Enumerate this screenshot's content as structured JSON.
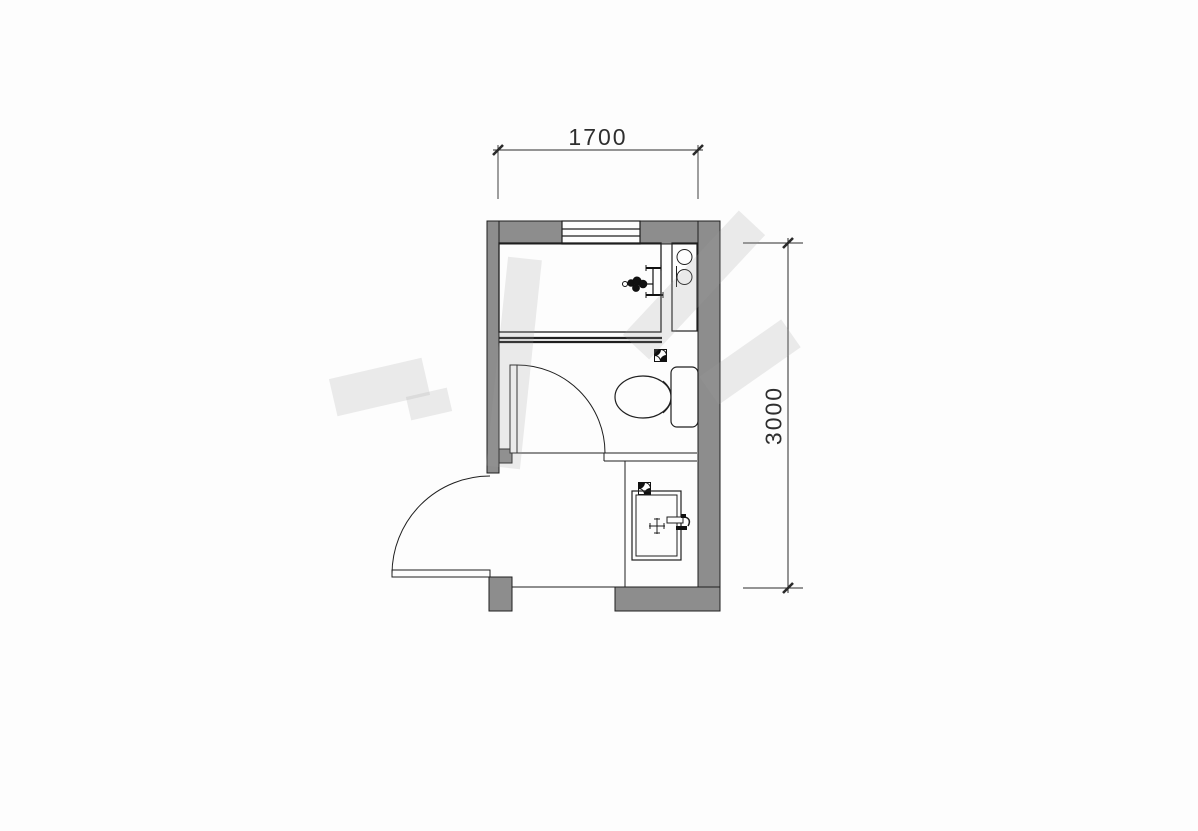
{
  "drawing": {
    "type": "architectural-floor-plan",
    "dimensions": {
      "top": {
        "label": "1700"
      },
      "right": {
        "label": "3000"
      }
    },
    "colors": {
      "wall": "#8d8d8d",
      "line": "#1f1f1f",
      "background": "#fdfdfd",
      "watermark": "rgba(160,160,160,0.20)"
    },
    "fixtures": [
      {
        "name": "window"
      },
      {
        "name": "shower-area"
      },
      {
        "name": "shower-shelf"
      },
      {
        "name": "shower-mixer"
      },
      {
        "name": "sliding-door"
      },
      {
        "name": "floor-drain-shower"
      },
      {
        "name": "floor-drain-basin"
      },
      {
        "name": "toilet"
      },
      {
        "name": "toilet-door"
      },
      {
        "name": "entry-door"
      },
      {
        "name": "wash-basin"
      },
      {
        "name": "basin-faucet"
      }
    ]
  }
}
